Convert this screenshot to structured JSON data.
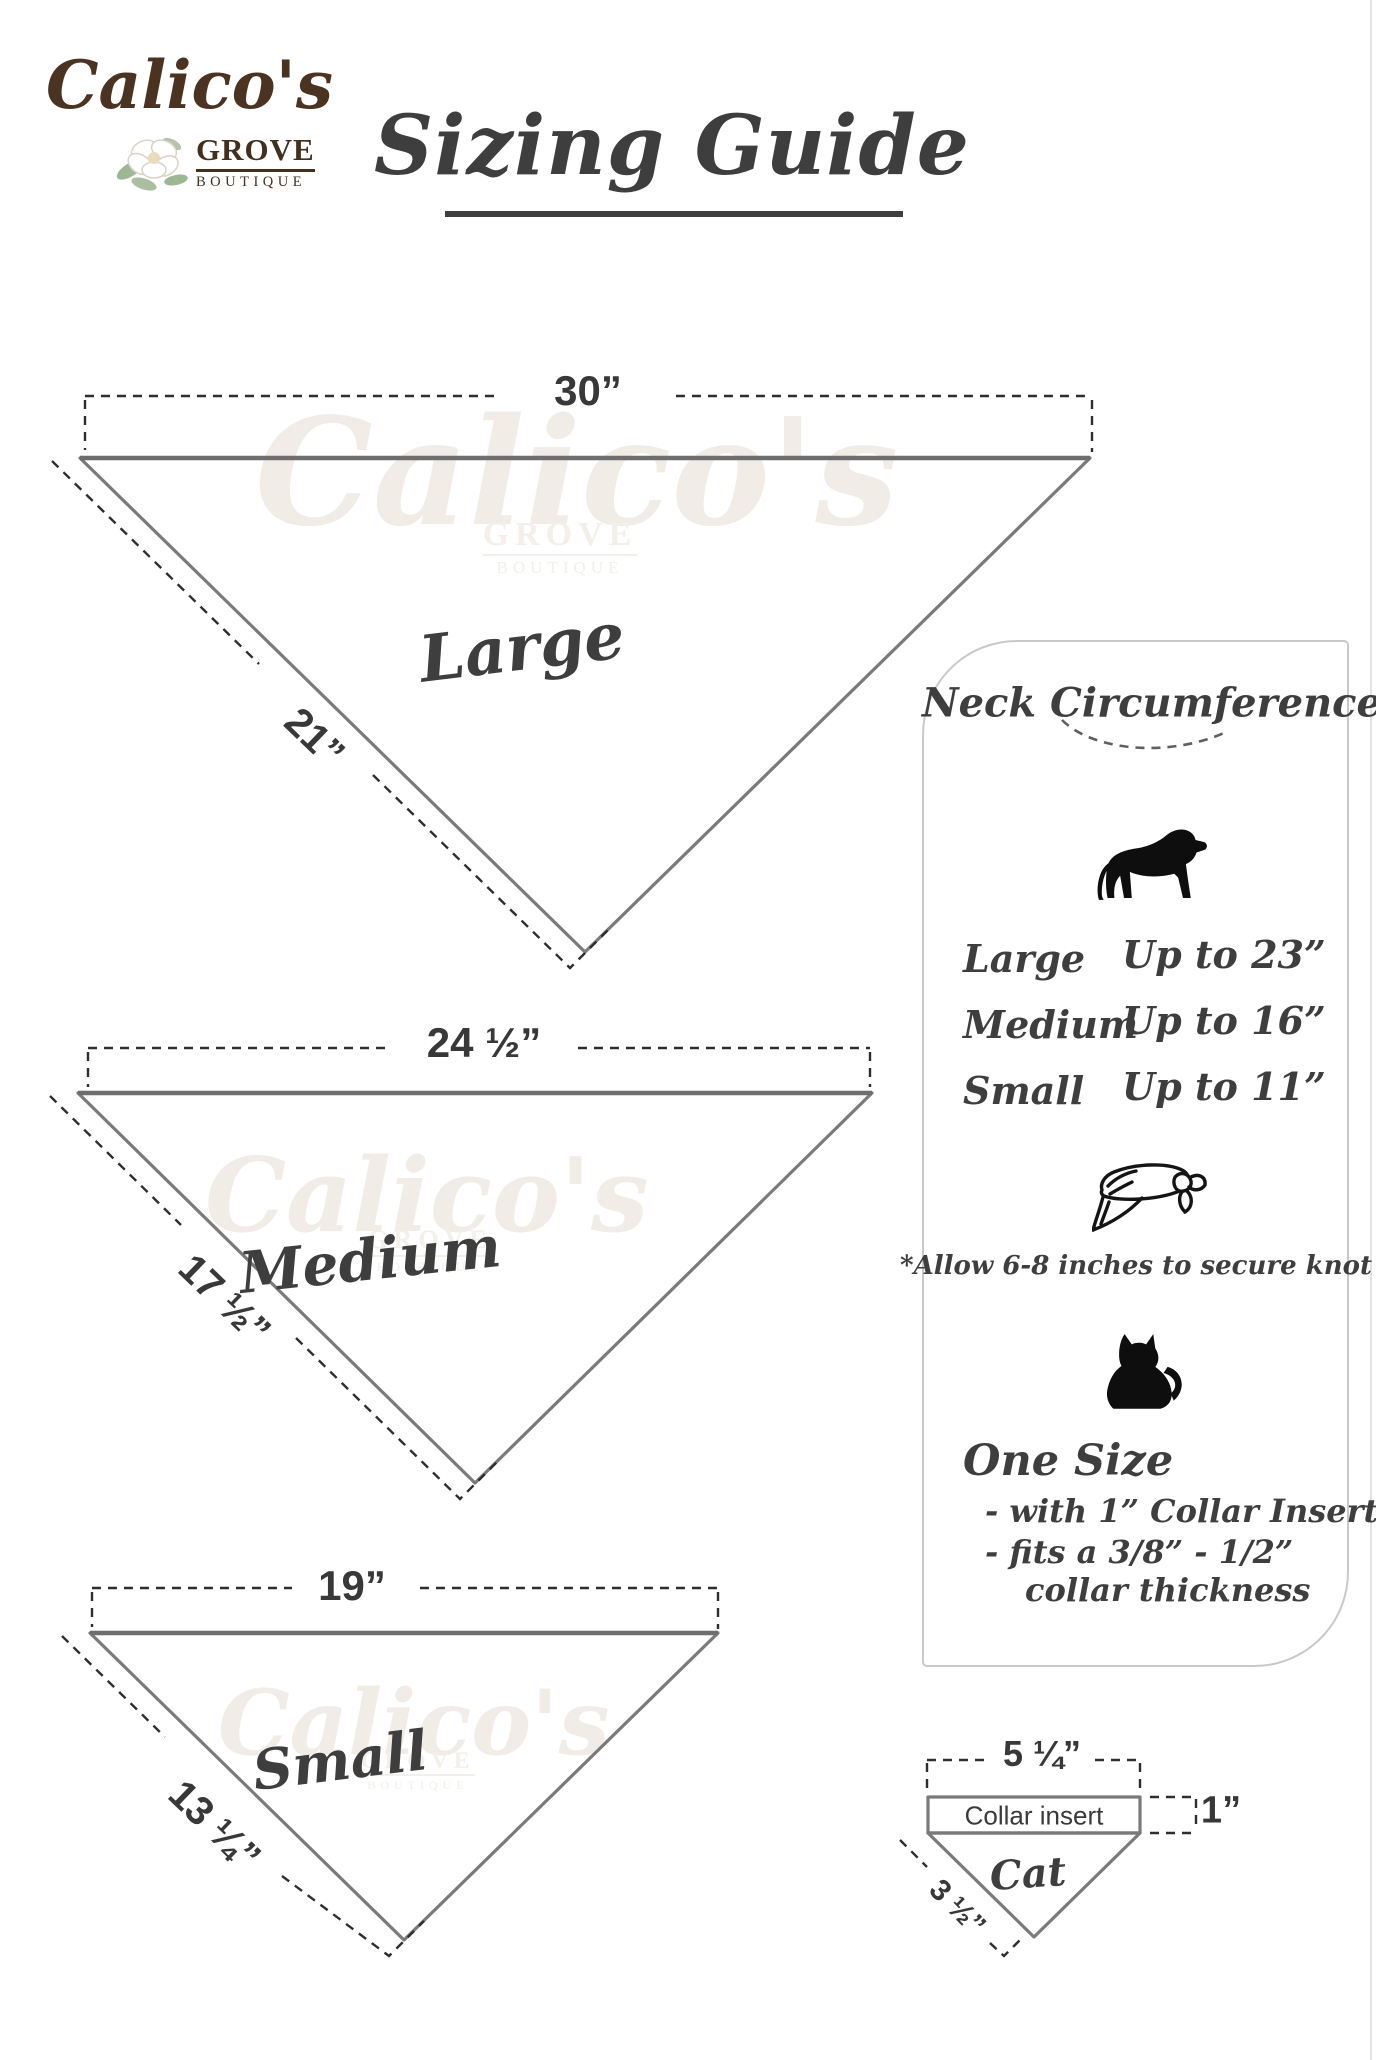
{
  "logo": {
    "brand": "Calico's",
    "grove": "GROVE",
    "boutique": "BOUTIQUE"
  },
  "title": {
    "text": "Sizing Guide"
  },
  "watermark": {
    "brand": "Calico's",
    "grove": "GROVE",
    "boutique": "BOUTIQUE"
  },
  "bandanas": [
    {
      "label": "Large",
      "top_width": "30”",
      "side_length": "21”"
    },
    {
      "label": "Medium",
      "top_width": "24 ½”",
      "side_length": "17 ½”"
    },
    {
      "label": "Small",
      "top_width": "19”",
      "side_length": "13 ¼”"
    }
  ],
  "neck_panel": {
    "heading": "Neck Circumference",
    "sizes": [
      {
        "label": "Large",
        "value": "Up to 23”"
      },
      {
        "label": "Medium",
        "value": "Up to 16”"
      },
      {
        "label": "Small",
        "value": "Up to 11”"
      }
    ],
    "knot_note": "*Allow 6-8 inches to secure knot",
    "one_size": {
      "heading": "One Size",
      "bullet1": "- with 1” Collar Insert",
      "bullet2": "- fits a 3/8” - 1/2”",
      "bullet3": "collar thickness"
    }
  },
  "cat_diagram": {
    "width_label": "5 ¼”",
    "insert_label": "Collar insert",
    "height_label": "1”",
    "name": "Cat",
    "side_label": "3 ½”"
  },
  "colors": {
    "brand_brown": "#4b3322",
    "text_dark": "#3e3e3e",
    "triangle_gray": "#7a7a7a",
    "dash_black": "#2e2e2e",
    "panel_border": "#c9c9c9",
    "watermark": "#f1ece5"
  }
}
